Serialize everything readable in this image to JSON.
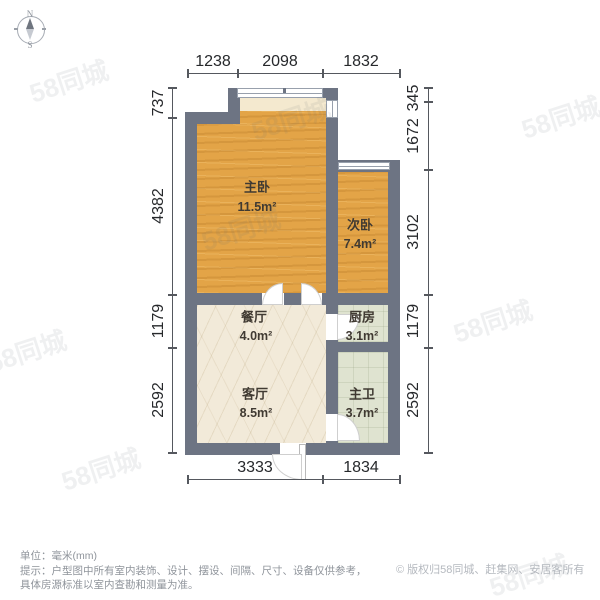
{
  "compass": {
    "north": "N",
    "south": "S"
  },
  "dimensions": {
    "top": [
      "1238",
      "2098",
      "1832"
    ],
    "bottom": [
      "3333",
      "1834"
    ],
    "left": [
      "737",
      "4382",
      "1179",
      "2592"
    ],
    "right": [
      "345",
      "1672",
      "3102",
      "1179",
      "2592"
    ]
  },
  "rooms": [
    {
      "id": "master-bedroom",
      "name": "主卧",
      "area": "11.5m²"
    },
    {
      "id": "second-bedroom",
      "name": "次卧",
      "area": "7.4m²"
    },
    {
      "id": "dining-room",
      "name": "餐厅",
      "area": "4.0m²"
    },
    {
      "id": "kitchen",
      "name": "厨房",
      "area": "3.1m²"
    },
    {
      "id": "living-room",
      "name": "客厅",
      "area": "8.5m²"
    },
    {
      "id": "master-bathroom",
      "name": "主卫",
      "area": "3.7m²"
    }
  ],
  "footer": {
    "unit_line": "单位：毫米(mm)",
    "note_line_1": "提示：户型图中所有室内装饰、设计、摆设、间隔、尺寸、设备仅供参考，",
    "note_line_2": "具体房源标准以室内查勘和测量为准。",
    "copyright": "© 版权归58同城、赶集网、安居客所有"
  },
  "watermark": {
    "text": "58同城"
  },
  "colors": {
    "wall": "#6d7483",
    "wood_floor": "#e3a447",
    "marble_floor": "#f2ead9",
    "tile_floor": "#dfe3d0",
    "dimension_text": "#26282b",
    "footer_text": "#8f949b",
    "copyright_text": "#b5b9bf"
  }
}
